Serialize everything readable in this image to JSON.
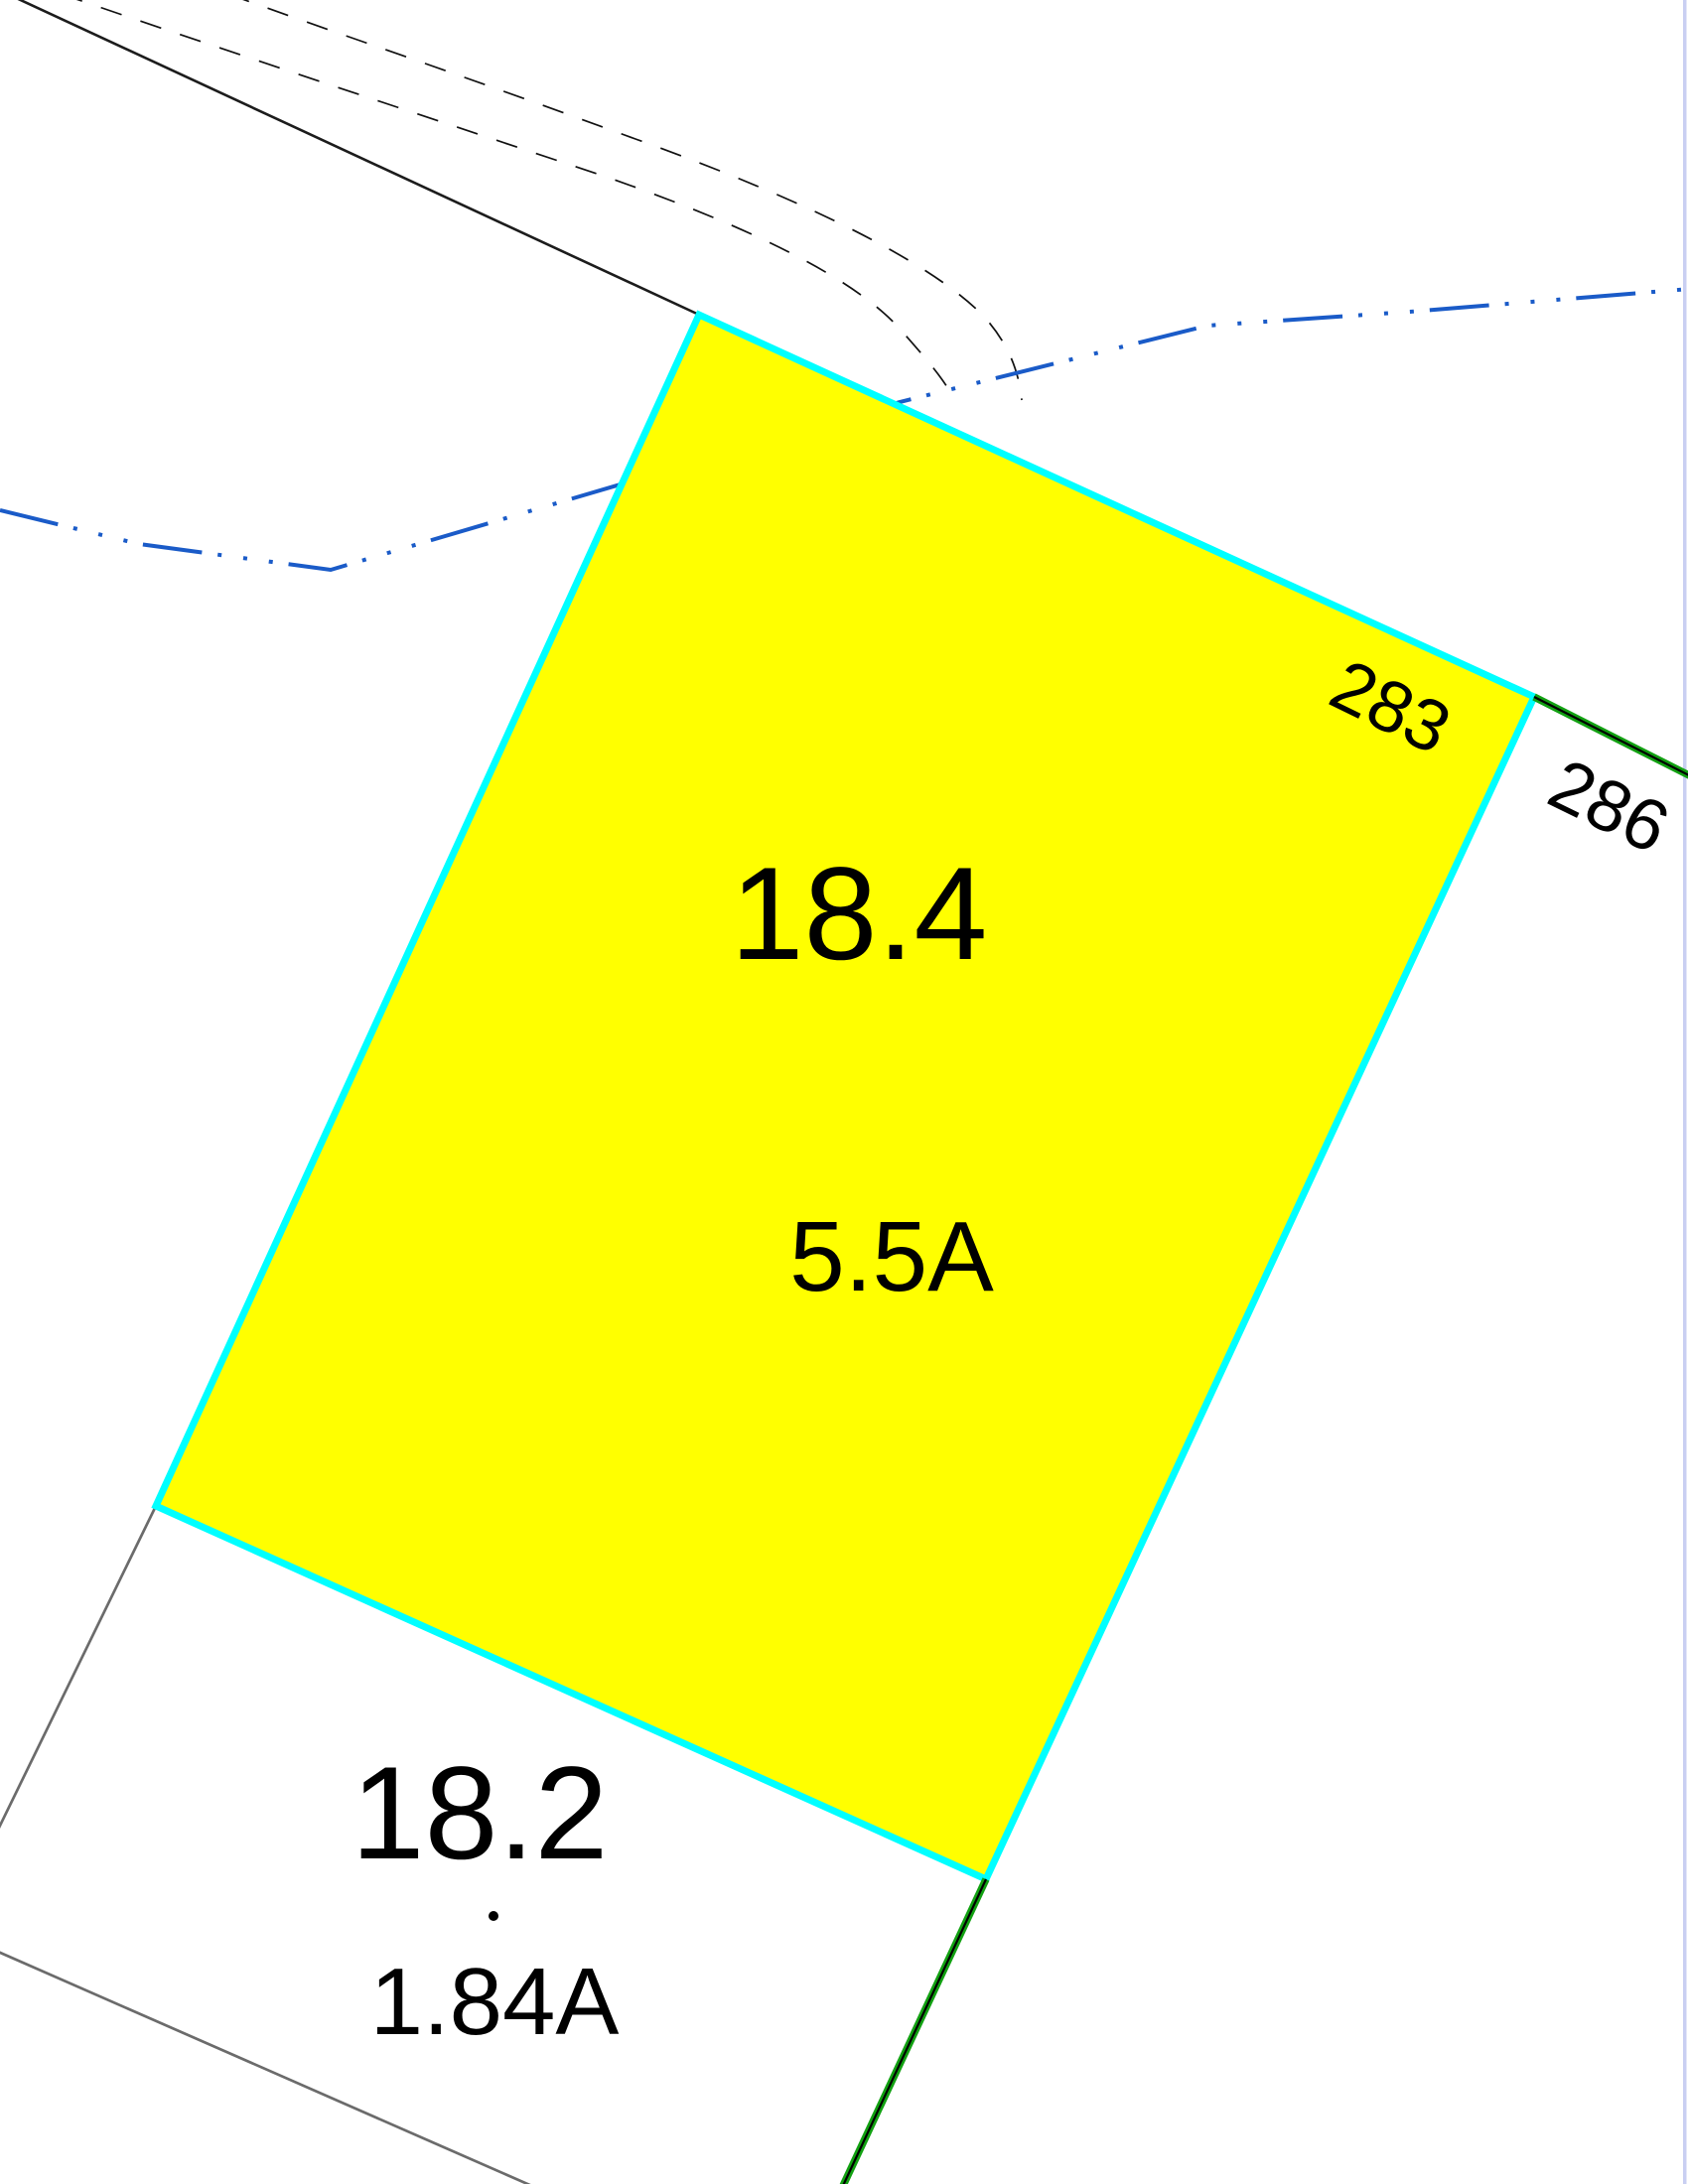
{
  "map": {
    "background_color": "#ffffff",
    "canvas_edge_color": "#c9cff2",
    "selected_parcel": {
      "lot_number": "18.4",
      "acreage": "5.5A",
      "fill_color": "#ffff00",
      "highlight_outline_color": "#00ffff"
    },
    "neighbor_parcel": {
      "lot_number": "18.2",
      "acreage": "1.84A",
      "boundary_color": "#6b6b6b"
    },
    "address_labels": {
      "label_283": "283",
      "label_286": "286"
    },
    "line_colors": {
      "stream_blue": "#1a5bc8",
      "road_dashed_black": "#111111",
      "boundary_solid_black": "#1c1c1c",
      "parcel_line_green": "#12a112",
      "green_line_core_black": "#000000"
    }
  }
}
